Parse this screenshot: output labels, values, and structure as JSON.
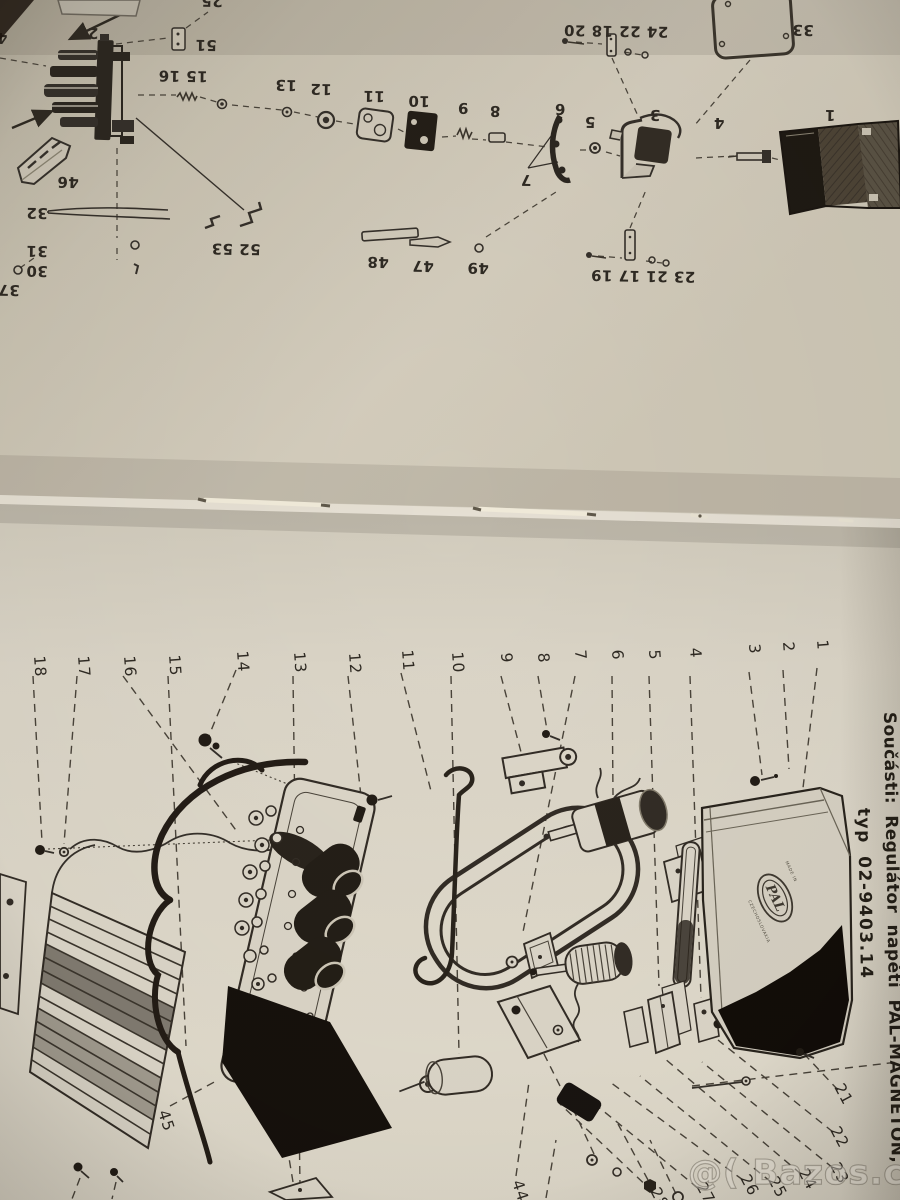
{
  "page_top": {
    "callouts": [
      {
        "t": "25",
        "x": 212,
        "y": -4
      },
      {
        "t": "4",
        "x": 2,
        "y": 33
      },
      {
        "t": "2",
        "x": 93,
        "y": 28
      },
      {
        "t": "51",
        "x": 206,
        "y": 40
      },
      {
        "t": "15 16",
        "x": 183,
        "y": 71
      },
      {
        "t": "13",
        "x": 286,
        "y": 80
      },
      {
        "t": "12",
        "x": 321,
        "y": 84
      },
      {
        "t": "11",
        "x": 374,
        "y": 91
      },
      {
        "t": "10",
        "x": 419,
        "y": 96
      },
      {
        "t": "9",
        "x": 463,
        "y": 103
      },
      {
        "t": "8",
        "x": 495,
        "y": 106
      },
      {
        "t": "6",
        "x": 560,
        "y": 104
      },
      {
        "t": "5",
        "x": 590,
        "y": 117
      },
      {
        "t": "7",
        "x": 526,
        "y": 175
      },
      {
        "t": "3",
        "x": 655,
        "y": 110
      },
      {
        "t": "4",
        "x": 719,
        "y": 118
      },
      {
        "t": "1",
        "x": 830,
        "y": 110
      },
      {
        "t": "33",
        "x": 803,
        "y": 25
      },
      {
        "t": "24 22 18 20",
        "x": 616,
        "y": 26
      },
      {
        "t": "23 21 17 19",
        "x": 643,
        "y": 271
      },
      {
        "t": "49",
        "x": 478,
        "y": 263
      },
      {
        "t": "47",
        "x": 423,
        "y": 261
      },
      {
        "t": "48",
        "x": 378,
        "y": 257
      },
      {
        "t": "52 53",
        "x": 236,
        "y": 244
      },
      {
        "t": "32",
        "x": 37,
        "y": 208
      },
      {
        "t": "31",
        "x": 37,
        "y": 246
      },
      {
        "t": "30",
        "x": 37,
        "y": 266
      },
      {
        "t": "37",
        "x": 9,
        "y": 285
      },
      {
        "t": "46",
        "x": 68,
        "y": 177
      }
    ]
  },
  "page_bottom": {
    "callouts_margin": [
      {
        "t": "18",
        "x": 34,
        "y": 656
      },
      {
        "t": "17",
        "x": 78,
        "y": 656
      },
      {
        "t": "16",
        "x": 124,
        "y": 656
      },
      {
        "t": "15",
        "x": 169,
        "y": 655
      },
      {
        "t": "14",
        "x": 237,
        "y": 651
      },
      {
        "t": "13",
        "x": 294,
        "y": 652
      },
      {
        "t": "12",
        "x": 349,
        "y": 653
      },
      {
        "t": "11",
        "x": 402,
        "y": 650
      },
      {
        "t": "10",
        "x": 452,
        "y": 652
      },
      {
        "t": "9",
        "x": 501,
        "y": 653
      },
      {
        "t": "8",
        "x": 538,
        "y": 653
      },
      {
        "t": "7",
        "x": 575,
        "y": 650
      },
      {
        "t": "6",
        "x": 612,
        "y": 650
      },
      {
        "t": "5",
        "x": 649,
        "y": 650
      },
      {
        "t": "4",
        "x": 690,
        "y": 648
      },
      {
        "t": "3",
        "x": 749,
        "y": 644
      },
      {
        "t": "2",
        "x": 783,
        "y": 642
      },
      {
        "t": "1",
        "x": 817,
        "y": 640
      }
    ],
    "callouts_corner": [
      {
        "t": "45",
        "x": 158,
        "y": 1112,
        "r": 72
      },
      {
        "t": "44",
        "x": 512,
        "y": 1182,
        "r": 72
      },
      {
        "t": "21",
        "x": 834,
        "y": 1087,
        "r": 62
      },
      {
        "t": "22",
        "x": 830,
        "y": 1130,
        "r": 62
      },
      {
        "t": "23",
        "x": 830,
        "y": 1166,
        "r": 62
      },
      {
        "t": "24",
        "x": 798,
        "y": 1172,
        "r": 62
      },
      {
        "t": "25",
        "x": 768,
        "y": 1180,
        "r": 62
      },
      {
        "t": "26",
        "x": 740,
        "y": 1178,
        "r": 62
      },
      {
        "t": "27",
        "x": 696,
        "y": 1186,
        "r": 62
      },
      {
        "t": "28",
        "x": 650,
        "y": 1191,
        "r": 62
      }
    ],
    "title_line1": "Součásti:  Regulátor  napětí  PAL-MAGNETON,",
    "title_line2": "typ 02-9403.14",
    "logo_text": "PAL",
    "logo_ring_text_1": "MADE IN",
    "logo_ring_text_2": "CZECHOSLOVAKIA"
  },
  "watermark": {
    "text": "@( Bazos.cz"
  },
  "colors": {
    "ink": "#2f2a23",
    "ink_soft": "#4a443a",
    "paper_top": "#cbc4b3",
    "paper_bottom": "#ded8ca",
    "housing_dark": "#14100b",
    "watermark_grey": "#8d867a"
  }
}
